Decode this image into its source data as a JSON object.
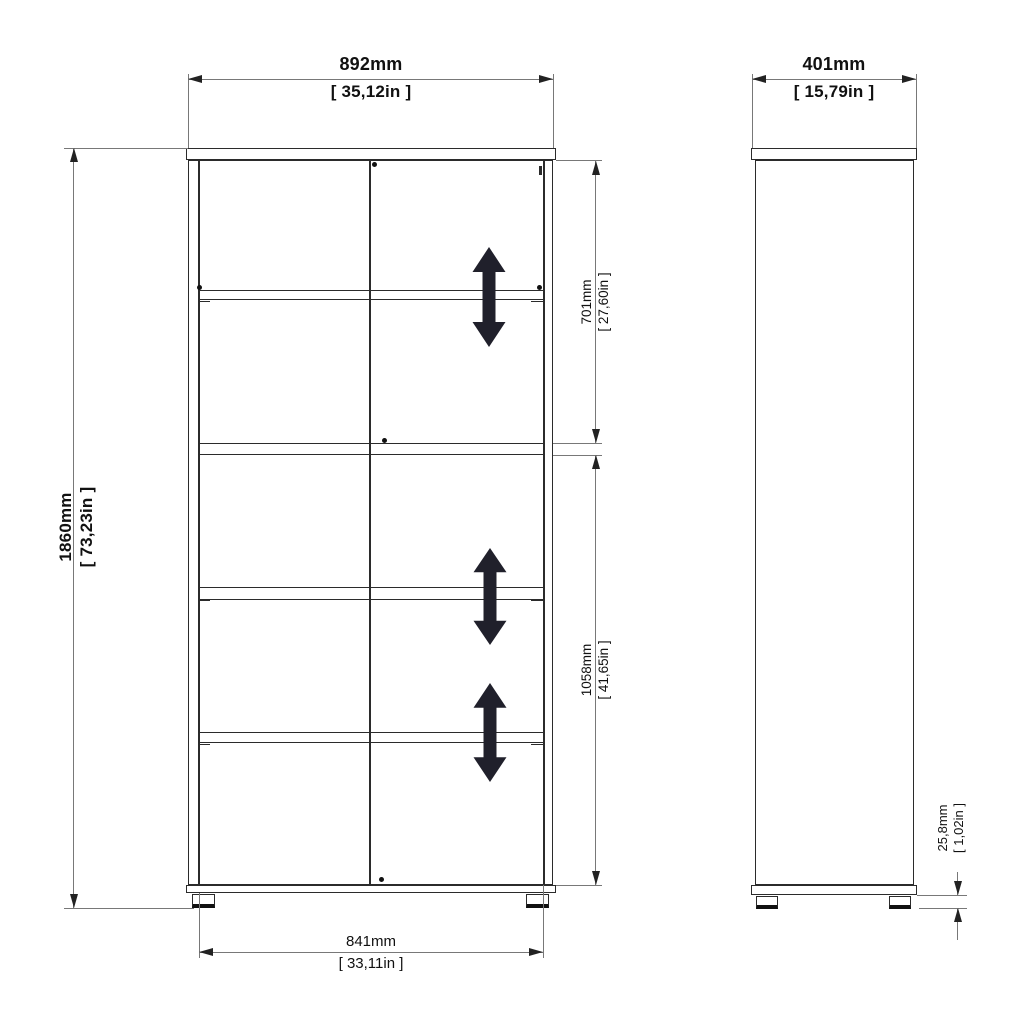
{
  "page": {
    "background": "#ffffff",
    "drawing_type": "bookcase dimension drawing, front and side views"
  },
  "colors": {
    "outline": "#2b2b2b",
    "dimension_line": "#787878",
    "text": "#111111",
    "arrow_fill": "#20202b"
  },
  "icons": {
    "shelf_adjust": "double-headed-vertical-arrow"
  },
  "dimensions": {
    "overall_width": {
      "mm": "892mm",
      "in": "[ 35,12in ]"
    },
    "depth": {
      "mm": "401mm",
      "in": "[ 15,79in ]"
    },
    "overall_height": {
      "mm": "1860mm",
      "in": "[ 73,23in ]"
    },
    "upper_section": {
      "mm": "701mm",
      "in": "[ 27,60in ]"
    },
    "lower_section": {
      "mm": "1058mm",
      "in": "[ 41,65in ]"
    },
    "bottom_width": {
      "mm": "841mm",
      "in": "[ 33,11in ]"
    },
    "foot_height": {
      "mm": "25,8mm",
      "in": "[ 1,02in ]"
    }
  }
}
